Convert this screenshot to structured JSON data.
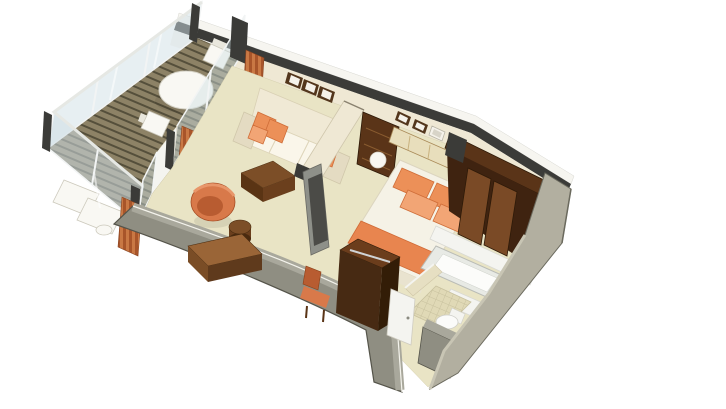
{
  "scene": {
    "type": "isometric-suite-floorplan",
    "areas": [
      "balcony",
      "living-room",
      "bedroom",
      "walk-in-closet",
      "bathroom",
      "entry-corridor"
    ]
  },
  "colors": {
    "background": "#ffffff",
    "wall_outer": "#f6f5f0",
    "wall_cap": "#3b3b38",
    "wall_inner": "#efe8d4",
    "carpet": "#e9e4c5",
    "deck_light": "#8d8266",
    "deck_dark": "#554f3b",
    "deck_edge": "#6e654c",
    "glass": "#cfdfe5",
    "glass_frame": "#f2f4f4",
    "hull_top": "#a9a89c",
    "hull_face": "#8f8e82",
    "hull_edge": "#55544a",
    "end_wall": "#b2afa0",
    "end_wall_edge": "#6b6a5e",
    "end_wall_bevel": "#c8c5b4",
    "curtain_dark": "#a8552a",
    "curtain_light": "#c97844",
    "sofa_cream": "#f0e9d5",
    "sofa_shade": "#e4dbc2",
    "cushion": "#faf6ea",
    "pillow": "#ec9058",
    "pillow_light": "#f2a575",
    "pillow_shade": "#cf6d38",
    "ottoman_top": "#7c4e27",
    "ottoman_side": "#5a3414",
    "ottoman_side2": "#6b3f1d",
    "chair_orange": "#d8794a",
    "chair_orange_dark": "#b85c31",
    "desk_top": "#9a6537",
    "desk_front": "#5f3a1c",
    "desk_side": "#7a4d26",
    "wood_mid": "#6b3d1c",
    "wood_dark": "#472a13",
    "wood_deep": "#331d07",
    "closet_back": "#5a3418",
    "closet_interior": "#3f2310",
    "closet_door": "#7a4a26",
    "headboard": "#e8debc",
    "headboard_trim": "#a98a58",
    "duvet": "#f5f2e6",
    "runner": "#e8854f",
    "runner_shade": "#d06a36",
    "lamp": "#f8f6f0",
    "frame_dark": "#53361c",
    "frame_mat": "#f5f2ea",
    "bath_wall": "#f4f4f0",
    "tub_rim": "#e8eae5",
    "tub_inner": "#fcfcfa",
    "tile": "#e0d9b6",
    "tile_line": "#c8c19e",
    "toilet": "#fbfbf9",
    "tv_slab": "#8e9089",
    "tv_screen": "#4b4b47",
    "white_furniture": "#f9f8f3",
    "divider_wall": "#e6dfc2"
  }
}
